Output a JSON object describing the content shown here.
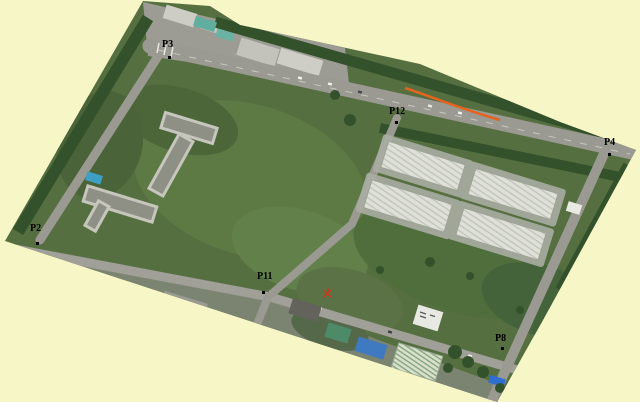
{
  "figure": {
    "type": "aerial-orthophoto-with-control-points",
    "background_color": "#f6f6c6"
  },
  "control_points": [
    {
      "id": "P3"
    },
    {
      "id": "P12"
    },
    {
      "id": "P4"
    },
    {
      "id": "P2"
    },
    {
      "id": "P11"
    },
    {
      "id": "P8"
    }
  ],
  "colors": {
    "background": "#f6f6c6",
    "label_text": "#000000",
    "orange_barrier": "#e2641e",
    "red_marker": "#cf3417",
    "field_green": "#566f41",
    "road_grey": "#9a9a92",
    "warehouse_roof": "#dfe1d9"
  }
}
